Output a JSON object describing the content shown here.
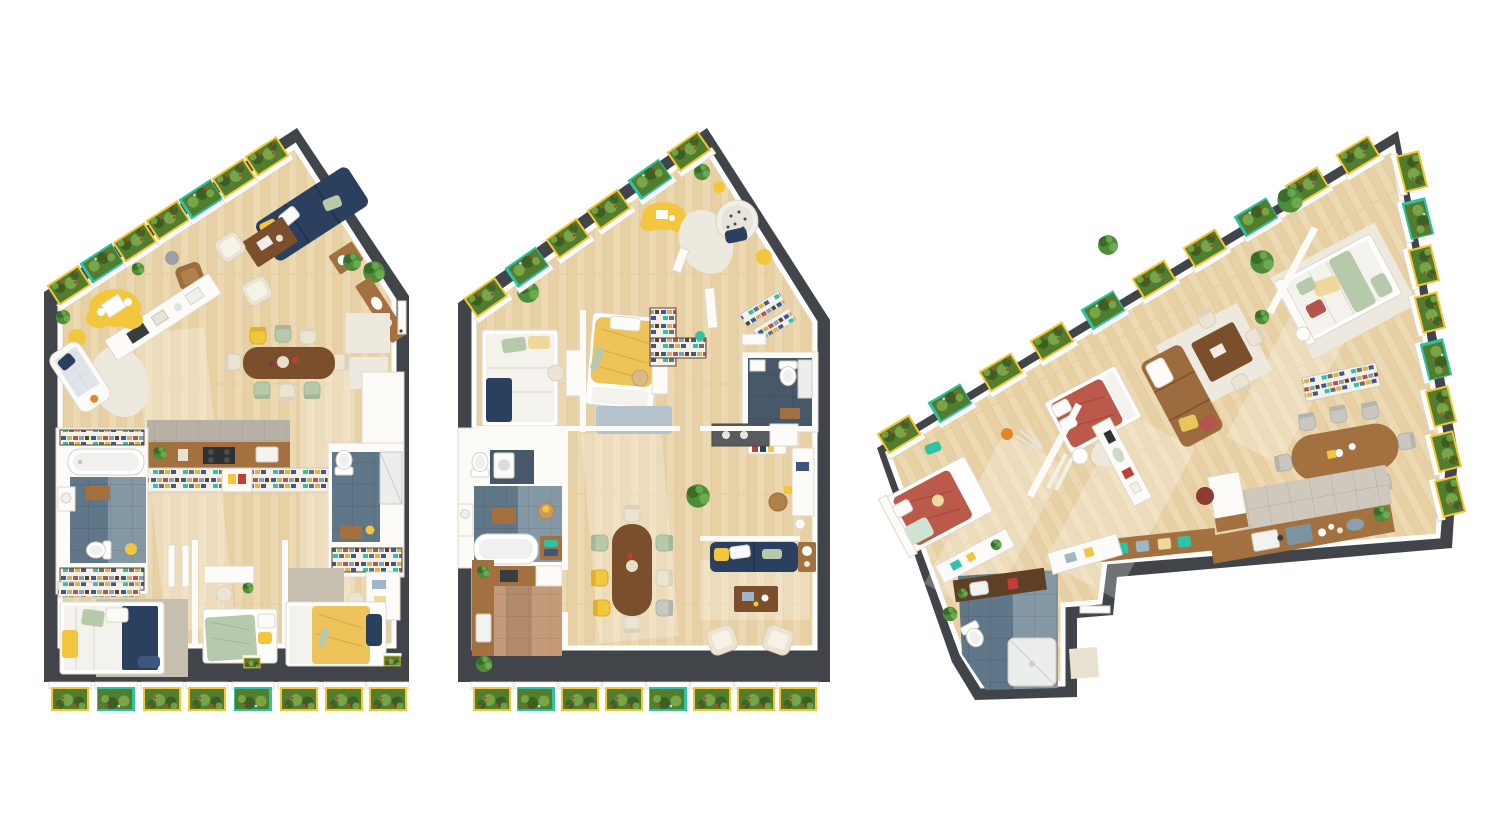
{
  "scene": {
    "description": "Three top-down 3D rendered apartment floor plans on a white background",
    "floorplans": [
      {
        "id": "floorplan-1",
        "shape": "pentagon with gabled top; balcony planter boxes along the upper-left slope and bottom edge",
        "planters_top": 7,
        "planters_bottom": 8,
        "rooms": [
          "living-room",
          "dining-area",
          "kitchen",
          "bathroom-with-tub",
          "shower-room",
          "bedroom-double",
          "bedroom-single",
          "bedroom-single"
        ]
      },
      {
        "id": "floorplan-2",
        "shape": "pentagon with gabled top; balcony planter boxes along the upper-left slope and bottom edge",
        "planters_top": 6,
        "planters_bottom": 8,
        "rooms": [
          "bedroom-double",
          "kids-bedroom",
          "lounge-corner",
          "entry",
          "bathroom",
          "office-nook",
          "bathroom-with-tub",
          "kitchen",
          "dining-area",
          "living-room"
        ]
      },
      {
        "id": "floorplan-3",
        "shape": "rotated wedge; planter boxes along the top slope and stepped right edge; angled bathroom wing at bottom-left",
        "planters_top": 10,
        "planters_right": 8,
        "rooms": [
          "bedroom-single",
          "bathroom-shower",
          "bedroom-single",
          "lounge",
          "dining-nook",
          "bedroom-double",
          "dining-area",
          "kitchen"
        ]
      }
    ]
  },
  "palette": {
    "background": "#ffffff",
    "wall_dark": "#414549",
    "white_furniture": "#fcfbf8",
    "white_shadow": "#ddd8cc",
    "floor_wood": "#e7d0a4",
    "floor_wood_light": "#f6e9c8",
    "plank_line": "#d3b689",
    "tile_blue": "#5f7788",
    "tile_blue_light": "#8498a6",
    "tile_blue_dark": "#46586a",
    "tile_gray": "#b7b0a4",
    "tile_terracotta": "#c49a78",
    "wood_mid": "#a3703f",
    "wood_dark": "#7b4e2c",
    "shelf_brown": "#5f4026",
    "leather": "#9c6c3f",
    "navy": "#2b3f5e",
    "navy_light": "#3d5680",
    "yellow": "#f2c63d",
    "yellow_soft": "#f0d89a",
    "sage": "#b6c9ab",
    "terracotta": "#bb5a4b",
    "terracotta_deep": "#a34437",
    "cream": "#ece4d3",
    "gray_rug": "#c6bfb0",
    "bluegray_rug": "#b4c2cc",
    "planter_green": "#527d2e",
    "planter_green_dark": "#38591f",
    "planter_green_light": "#7cab4a",
    "planter_trim_yellow": "#f3c537",
    "planter_trim_teal": "#2ec3a4",
    "plant_green": "#4e8c3a",
    "plant_green_dark": "#346325",
    "flower_red": "#c23d33",
    "accent_teal": "#2ec3a4",
    "accent_orange": "#e2862b"
  }
}
